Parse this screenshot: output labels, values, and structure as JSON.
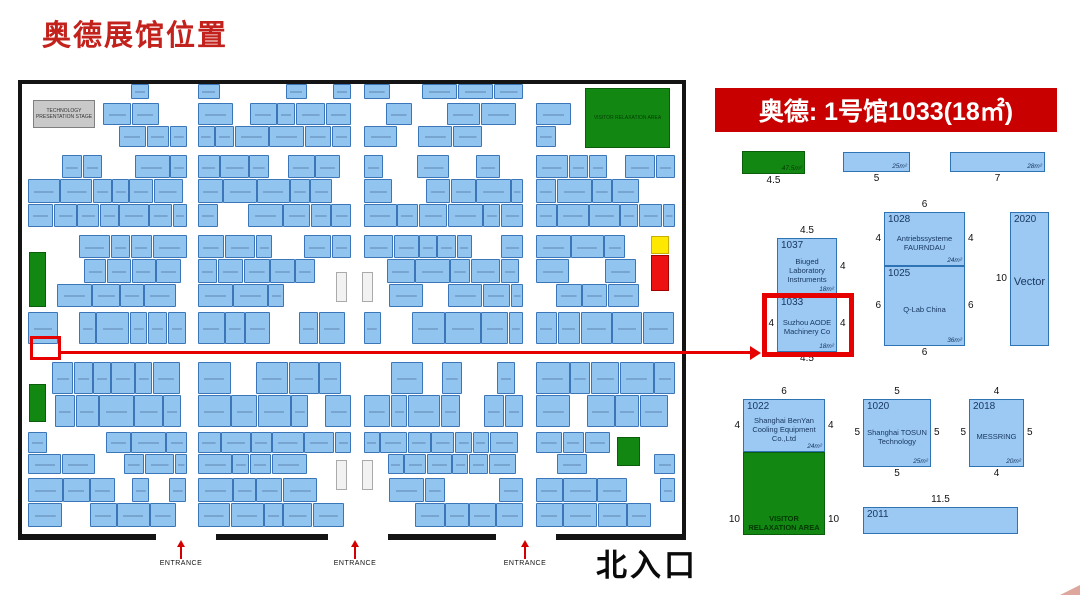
{
  "title": "奥德展馆位置",
  "banner": {
    "text": "奥德: 1号馆1033(18㎡)"
  },
  "colors": {
    "title_red": "#c3211c",
    "banner_red": "#c80000",
    "locator_red": "#e60000",
    "booth_blue": "#92c4f0",
    "booth_border": "#3a76b8",
    "green": "#128812",
    "yellow": "#ffe800",
    "alert_red": "#ee1111",
    "text_navy": "#17365d"
  },
  "mainmap": {
    "north_label": "北入口",
    "entrance_label": "ENTRANCE",
    "stage_label": "TECHNOLOGY PRESENTATION STAGE",
    "visitor_label": "VISITOR RELAXATION AREA",
    "seed": 13,
    "col_bands": [
      [
        6,
        166
      ],
      [
        176,
        330
      ],
      [
        342,
        502
      ],
      [
        514,
        654
      ]
    ],
    "bands": [
      {
        "y": 0,
        "h": 16,
        "rows": 1,
        "fill": 0.5
      },
      {
        "y": 19,
        "h": 45,
        "rows": 2,
        "fill": 0.85
      },
      {
        "y": 71,
        "h": 73,
        "rows": 3,
        "fill": 0.85
      },
      {
        "y": 151,
        "h": 73,
        "rows": 3,
        "fill": 0.85
      },
      {
        "y": 228,
        "h": 33,
        "rows": 1,
        "fill": 0.85
      },
      {
        "y": 278,
        "h": 66,
        "rows": 2,
        "fill": 0.85
      },
      {
        "y": 348,
        "h": 43,
        "rows": 2,
        "fill": 0.82
      },
      {
        "y": 394,
        "h": 50,
        "rows": 2,
        "fill": 0.82
      }
    ],
    "holes": [
      [
        8,
        0,
        70,
        52
      ],
      [
        558,
        0,
        94,
        68
      ],
      [
        4,
        164,
        24,
        64
      ],
      [
        4,
        296,
        24,
        48
      ],
      [
        591,
        349,
        34,
        38
      ],
      [
        625,
        148,
        28,
        64
      ],
      [
        308,
        184,
        48,
        38
      ],
      [
        308,
        372,
        48,
        38
      ]
    ],
    "features": [
      {
        "type": "stage",
        "x": 11,
        "y": 16,
        "w": 62,
        "h": 28,
        "label": "TECHNOLOGY PRESENTATION STAGE",
        "name": "technology-presentation-stage"
      },
      {
        "type": "green",
        "x": 563,
        "y": 4,
        "w": 85,
        "h": 60,
        "label": "VISITOR RELAXATION AREA",
        "name": "visitor-relaxation-area"
      },
      {
        "type": "green",
        "x": 7,
        "y": 168,
        "w": 17,
        "h": 55,
        "label": "",
        "name": "green-area"
      },
      {
        "type": "green",
        "x": 7,
        "y": 300,
        "w": 17,
        "h": 38,
        "label": "",
        "name": "green-area"
      },
      {
        "type": "green",
        "x": 595,
        "y": 353,
        "w": 23,
        "h": 29,
        "label": "",
        "name": "green-area"
      },
      {
        "type": "yellow",
        "x": 629,
        "y": 152,
        "w": 18,
        "h": 18,
        "label": "",
        "name": "yellow-booth"
      },
      {
        "type": "red",
        "x": 629,
        "y": 171,
        "w": 18,
        "h": 36,
        "label": "",
        "name": "red-booth"
      },
      {
        "type": "pillar",
        "x": 314,
        "y": 188,
        "w": 11,
        "h": 30,
        "label": "",
        "name": "pillar"
      },
      {
        "type": "pillar",
        "x": 340,
        "y": 188,
        "w": 11,
        "h": 30,
        "label": "",
        "name": "pillar"
      },
      {
        "type": "pillar",
        "x": 314,
        "y": 376,
        "w": 11,
        "h": 30,
        "label": "",
        "name": "pillar"
      },
      {
        "type": "pillar",
        "x": 340,
        "y": 376,
        "w": 11,
        "h": 30,
        "label": "",
        "name": "pillar"
      }
    ],
    "border_segments": [
      [
        18,
        138
      ],
      [
        216,
        112
      ],
      [
        388,
        108
      ],
      [
        556,
        130
      ]
    ],
    "entrances": [
      {
        "x": 181
      },
      {
        "x": 355
      },
      {
        "x": 525
      }
    ],
    "highlight": {
      "x": 30,
      "y": 336,
      "w": 31,
      "h": 24
    },
    "connector": {
      "x1": 61,
      "x2": 750,
      "y": 351
    }
  },
  "detail": {
    "highlight": {
      "x": 762,
      "y": 293,
      "w": 92,
      "h": 64
    },
    "booths": [
      {
        "key": "green-47",
        "id": "",
        "name": "",
        "area": "47.5m²",
        "x": 742,
        "y": 151,
        "w": 63,
        "h": 23,
        "color": "green",
        "dims": [
          {
            "side": "bottom",
            "v": "4.5"
          }
        ]
      },
      {
        "key": "strip-25",
        "id": "",
        "name": "",
        "area": "25m²",
        "x": 843,
        "y": 152,
        "w": 67,
        "h": 20,
        "color": "blue",
        "dims": [
          {
            "side": "bottom",
            "v": "5"
          }
        ]
      },
      {
        "key": "strip-28",
        "id": "",
        "name": "",
        "area": "28m²",
        "x": 950,
        "y": 152,
        "w": 95,
        "h": 20,
        "color": "blue",
        "dims": [
          {
            "side": "bottom",
            "v": "7"
          }
        ]
      },
      {
        "key": "1037",
        "id": "1037",
        "name": "Biuged Laboratory Instruments",
        "area": "18m²",
        "x": 777,
        "y": 238,
        "w": 60,
        "h": 57,
        "color": "blue",
        "dims": [
          {
            "side": "top",
            "v": "4.5"
          },
          {
            "side": "right",
            "v": "4"
          }
        ]
      },
      {
        "key": "1033",
        "id": "1033",
        "name": "Suzhou AODE Machinery Co",
        "area": "18m²",
        "x": 777,
        "y": 295,
        "w": 60,
        "h": 57,
        "color": "blue",
        "dims": [
          {
            "side": "left",
            "v": "4"
          },
          {
            "side": "right",
            "v": "4"
          },
          {
            "side": "bottom",
            "v": "4.5"
          }
        ]
      },
      {
        "key": "1028",
        "id": "1028",
        "name": "Antriebssysteme FAURNDAU",
        "area": "24m²",
        "x": 884,
        "y": 212,
        "w": 81,
        "h": 54,
        "color": "blue",
        "dims": [
          {
            "side": "top",
            "v": "6"
          },
          {
            "side": "left",
            "v": "4"
          },
          {
            "side": "right",
            "v": "4"
          }
        ]
      },
      {
        "key": "1025",
        "id": "1025",
        "name": "Q-Lab China",
        "area": "36m²",
        "x": 884,
        "y": 266,
        "w": 81,
        "h": 80,
        "color": "blue",
        "dims": [
          {
            "side": "left",
            "v": "6"
          },
          {
            "side": "right",
            "v": "6"
          },
          {
            "side": "bottom",
            "v": "6"
          }
        ]
      },
      {
        "key": "2020",
        "id": "2020",
        "name": "Vector",
        "area": "",
        "x": 1010,
        "y": 212,
        "w": 39,
        "h": 134,
        "color": "blue",
        "nameSize": 11,
        "dims": [
          {
            "side": "left",
            "v": "10"
          }
        ]
      },
      {
        "key": "1022",
        "id": "1022",
        "name": "Shanghai BenYan Cooling Equipment Co.,Ltd",
        "area": "24m²",
        "x": 743,
        "y": 399,
        "w": 82,
        "h": 53,
        "color": "blue",
        "dims": [
          {
            "side": "top",
            "v": "6"
          },
          {
            "side": "left",
            "v": "4"
          },
          {
            "side": "right",
            "v": "4"
          }
        ]
      },
      {
        "key": "visitor-area",
        "id": "",
        "name": "VISITOR RELAXATION AREA",
        "area": "",
        "x": 743,
        "y": 452,
        "w": 82,
        "h": 83,
        "color": "green",
        "dims": [
          {
            "side": "left",
            "v": "10",
            "at": 0.82
          },
          {
            "side": "right",
            "v": "10",
            "at": 0.82
          }
        ]
      },
      {
        "key": "1020",
        "id": "1020",
        "name": "Shanghai TOSUN Technology",
        "area": "25m²",
        "x": 863,
        "y": 399,
        "w": 68,
        "h": 68,
        "color": "blue",
        "dims": [
          {
            "side": "top",
            "v": "5"
          },
          {
            "side": "left",
            "v": "5"
          },
          {
            "side": "right",
            "v": "5"
          },
          {
            "side": "bottom",
            "v": "5"
          }
        ]
      },
      {
        "key": "2018",
        "id": "2018",
        "name": "MESSRING",
        "area": "20m²",
        "x": 969,
        "y": 399,
        "w": 55,
        "h": 68,
        "color": "blue",
        "dims": [
          {
            "side": "top",
            "v": "4"
          },
          {
            "side": "left",
            "v": "5"
          },
          {
            "side": "right",
            "v": "5"
          },
          {
            "side": "bottom",
            "v": "4"
          }
        ]
      },
      {
        "key": "2011",
        "id": "2011",
        "name": "",
        "area": "",
        "x": 863,
        "y": 507,
        "w": 155,
        "h": 27,
        "color": "blue",
        "dims": [
          {
            "side": "top",
            "v": "11.5"
          }
        ]
      }
    ]
  }
}
